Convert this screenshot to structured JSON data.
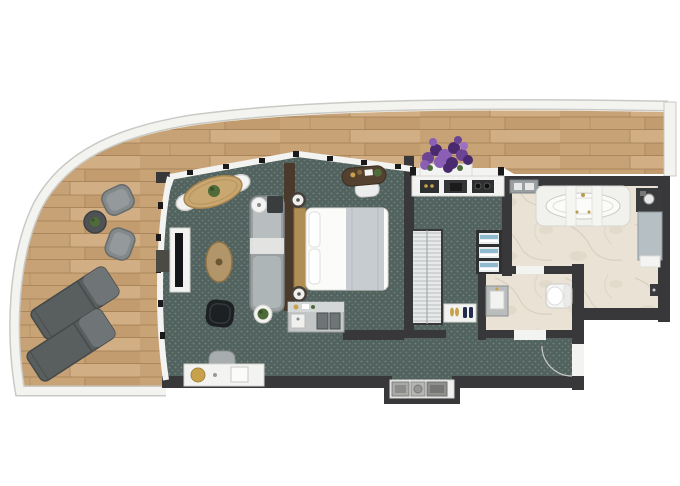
{
  "meta": {
    "kind": "apartment-floor-plan-rendering",
    "view": "top-down",
    "visible_text": [],
    "canvas": {
      "width": 680,
      "height": 486
    }
  },
  "palette": {
    "background": "#ffffff",
    "railing": "#f3f3f0",
    "railing-edge": "#c9c9c5",
    "wood": "#c8a376",
    "wood-light": "#dbbc92",
    "wood-dark": "#b0885c",
    "wood-line": "#9e7a50",
    "wall": "#38383a",
    "partition": "#4a3a2b",
    "carpet": "#52625e",
    "carpet-dot": "#7d8d88",
    "marble": "#e9e2d5",
    "marble-vein": "#d2c7b4",
    "white-fixture": "#f3f3f1",
    "sofa": "#9aa0a1",
    "sofa-light": "#b8bebf",
    "lounger": "#595e5f",
    "lounger-light": "#6f7576",
    "chair-gray": "#83888a",
    "table-wood": "#c9a770",
    "coffee-wood": "#b2966a",
    "dark-wood": "#53402e",
    "black-furniture": "#1d2022",
    "tv-black": "#141619",
    "gold": "#c7a14b",
    "plant-green": "#4e6b39",
    "flower-purple": "#6b4494",
    "flower-purple-dark": "#4a2a6e",
    "flower-purple-light": "#8a5fb5",
    "towel-blue": "#8fb9cf",
    "shoe-navy": "#232c4e",
    "shower-gray": "#b6bfc3",
    "steel": "#393a3b"
  },
  "rooms": [
    {
      "id": "balcony",
      "label": "curved balcony terrace",
      "floor": "wood-deck",
      "furniture": [
        "bistro-chair",
        "bistro-chair",
        "bistro-table-with-plant",
        "sun-lounger",
        "sun-lounger",
        "lavender-planter"
      ]
    },
    {
      "id": "living-room",
      "label": "living room",
      "floor": "teal-carpet",
      "furniture": [
        "oval-dining-table",
        "dining-chair",
        "dining-chair",
        "tv-console",
        "tv",
        "oval-coffee-table",
        "black-armchair",
        "sofa",
        "side-table",
        "plant-table",
        "dressing-console",
        "stool"
      ]
    },
    {
      "id": "bedroom",
      "label": "bedroom",
      "floor": "teal-carpet",
      "furniture": [
        "double-bed",
        "headboard",
        "nightstand",
        "nightstand",
        "writing-desk",
        "desk-chair",
        "minibar-counter"
      ]
    },
    {
      "id": "kitchenette",
      "label": "kitchenette",
      "floor": "teal-carpet",
      "furniture": [
        "counter",
        "cooktop",
        "sink"
      ]
    },
    {
      "id": "wardrobe-corridor",
      "label": "dressing corridor",
      "floor": "teal-carpet",
      "furniture": [
        "louvered-wardrobe",
        "shoe-mat",
        "towel-shelf"
      ]
    },
    {
      "id": "bathroom",
      "label": "main bathroom",
      "floor": "marble",
      "furniture": [
        "bathtub",
        "wall-shelf",
        "shower-column",
        "shower-mat",
        "wall-faucet"
      ]
    },
    {
      "id": "toilet-room",
      "label": "toilet room",
      "floor": "marble",
      "furniture": [
        "vanity-sink",
        "toilet"
      ]
    },
    {
      "id": "hallway",
      "label": "entry hallway",
      "floor": "teal-carpet",
      "furniture": [
        "entry-door",
        "utility-niche"
      ]
    }
  ]
}
